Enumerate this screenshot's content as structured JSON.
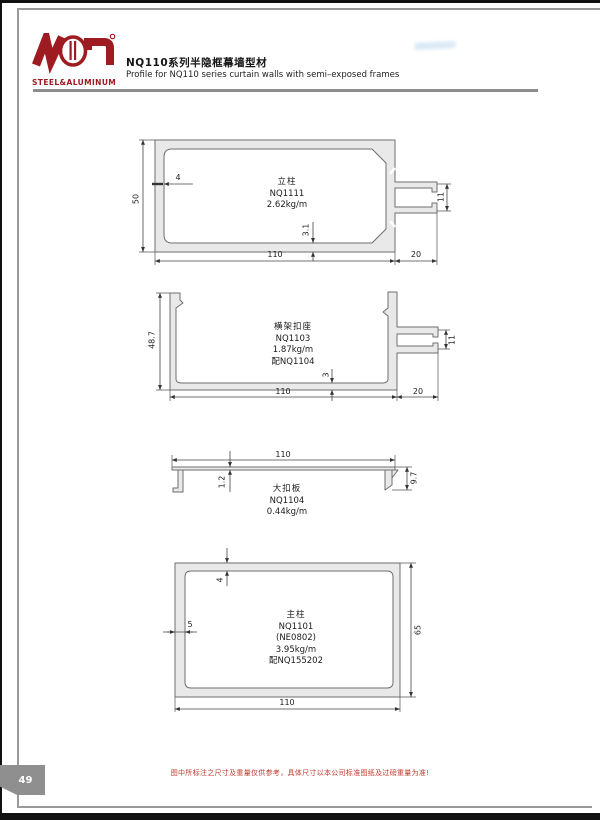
{
  "page": {
    "number": "49",
    "footer_note": "图中所标注之尺寸及重量仅供参考，具体尺寸以本公司标准图纸及过磅重量为准!"
  },
  "header": {
    "logo_text": "STEEL&ALUMINUM",
    "title_cn": "NQ110系列半隐框幕墙型材",
    "title_en": "Profile for NQ110 series curtain walls with semi–exposed frames",
    "brand_color": "#9e1c21"
  },
  "drawings": [
    {
      "name": "立柱",
      "code": "NQ1111",
      "weight": "2.62kg/m",
      "dims": {
        "height": "50",
        "wall": "4",
        "web": "3.1",
        "width": "110",
        "tab_len": "20",
        "tab_gap": "11"
      }
    },
    {
      "name": "横架扣座",
      "code": "NQ1103",
      "weight": "1.87kg/m",
      "match": "配NQ1104",
      "dims": {
        "height": "48.7",
        "width": "110",
        "tab_len": "20",
        "tab_gap": "11",
        "base": "3"
      }
    },
    {
      "name": "大扣板",
      "code": "NQ1104",
      "weight": "0.44kg/m",
      "dims": {
        "width": "110",
        "thickness": "1.2",
        "leg": "9.7"
      }
    },
    {
      "name": "主柱",
      "code": "NQ1101",
      "alt_code": "(NE0802)",
      "weight": "3.95kg/m",
      "match": "配NQ155202",
      "dims": {
        "top_wall": "4",
        "side_wall": "5",
        "height": "65",
        "width": "110"
      }
    }
  ]
}
